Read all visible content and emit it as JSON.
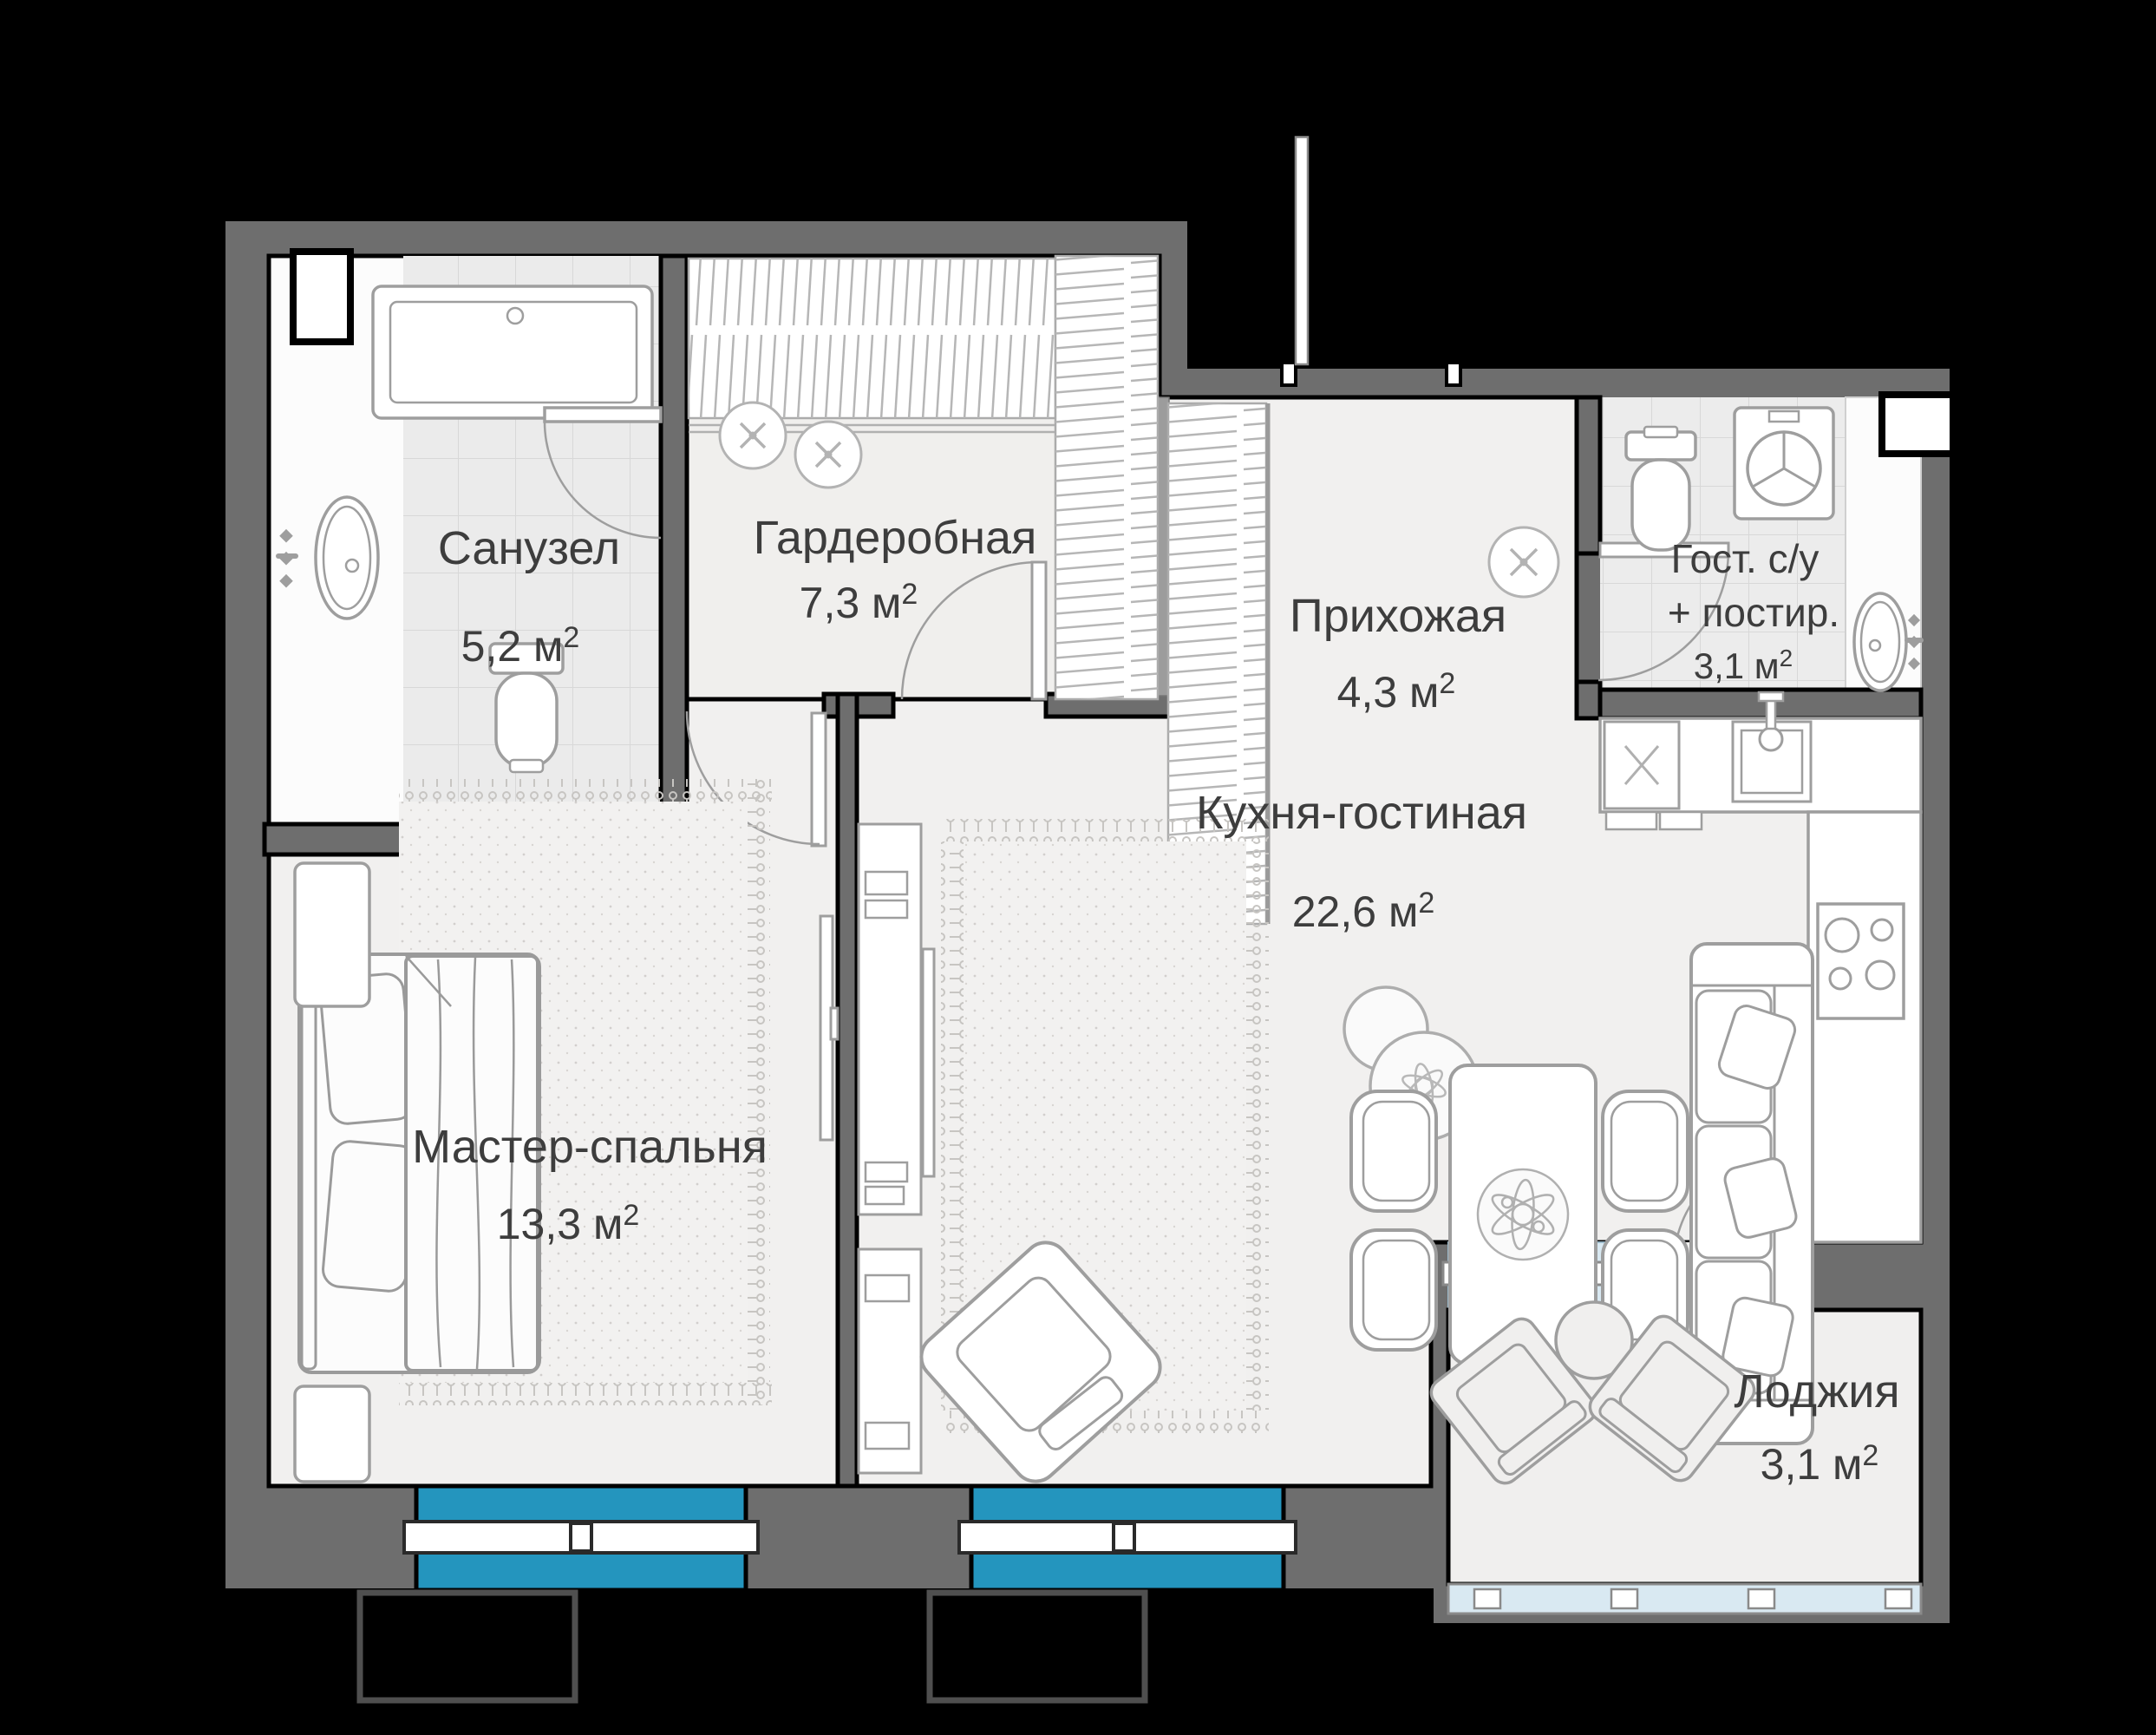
{
  "page": {
    "background": "#000000"
  },
  "plan": {
    "type": "apartment-floor-plan",
    "language": "ru",
    "colors": {
      "walls": "#6E6E6E",
      "floor": "#F1F0EF",
      "bath_tiles": "#EBEBEB",
      "window_glass": "#2495BE",
      "loggia_glazing": "#D9E9F2",
      "outline": "#000000",
      "furniture_stroke": "#9E9E9E",
      "label_text": "#3D3D3D"
    },
    "rooms": {
      "bathroom": {
        "name": "Санузел",
        "area": "5,2 м",
        "area_sup": "2"
      },
      "wardrobe": {
        "name": "Гардеробная",
        "area": "7,3 м",
        "area_sup": "2"
      },
      "hallway": {
        "name": "Прихожая",
        "area": "4,3 м",
        "area_sup": "2"
      },
      "guest_wc": {
        "name_line1": "Гост. с/у",
        "name_line2": "+ постир.",
        "area": "3,1 м",
        "area_sup": "2"
      },
      "kitchen_living": {
        "name": "Кухня-гостиная",
        "area": "22,6 м",
        "area_sup": "2"
      },
      "master_bedroom": {
        "name": "Мастер-спальня",
        "area": "13,3 м",
        "area_sup": "2"
      },
      "loggia": {
        "name": "Лоджия",
        "area": "3,1 м",
        "area_sup": "2"
      }
    }
  }
}
